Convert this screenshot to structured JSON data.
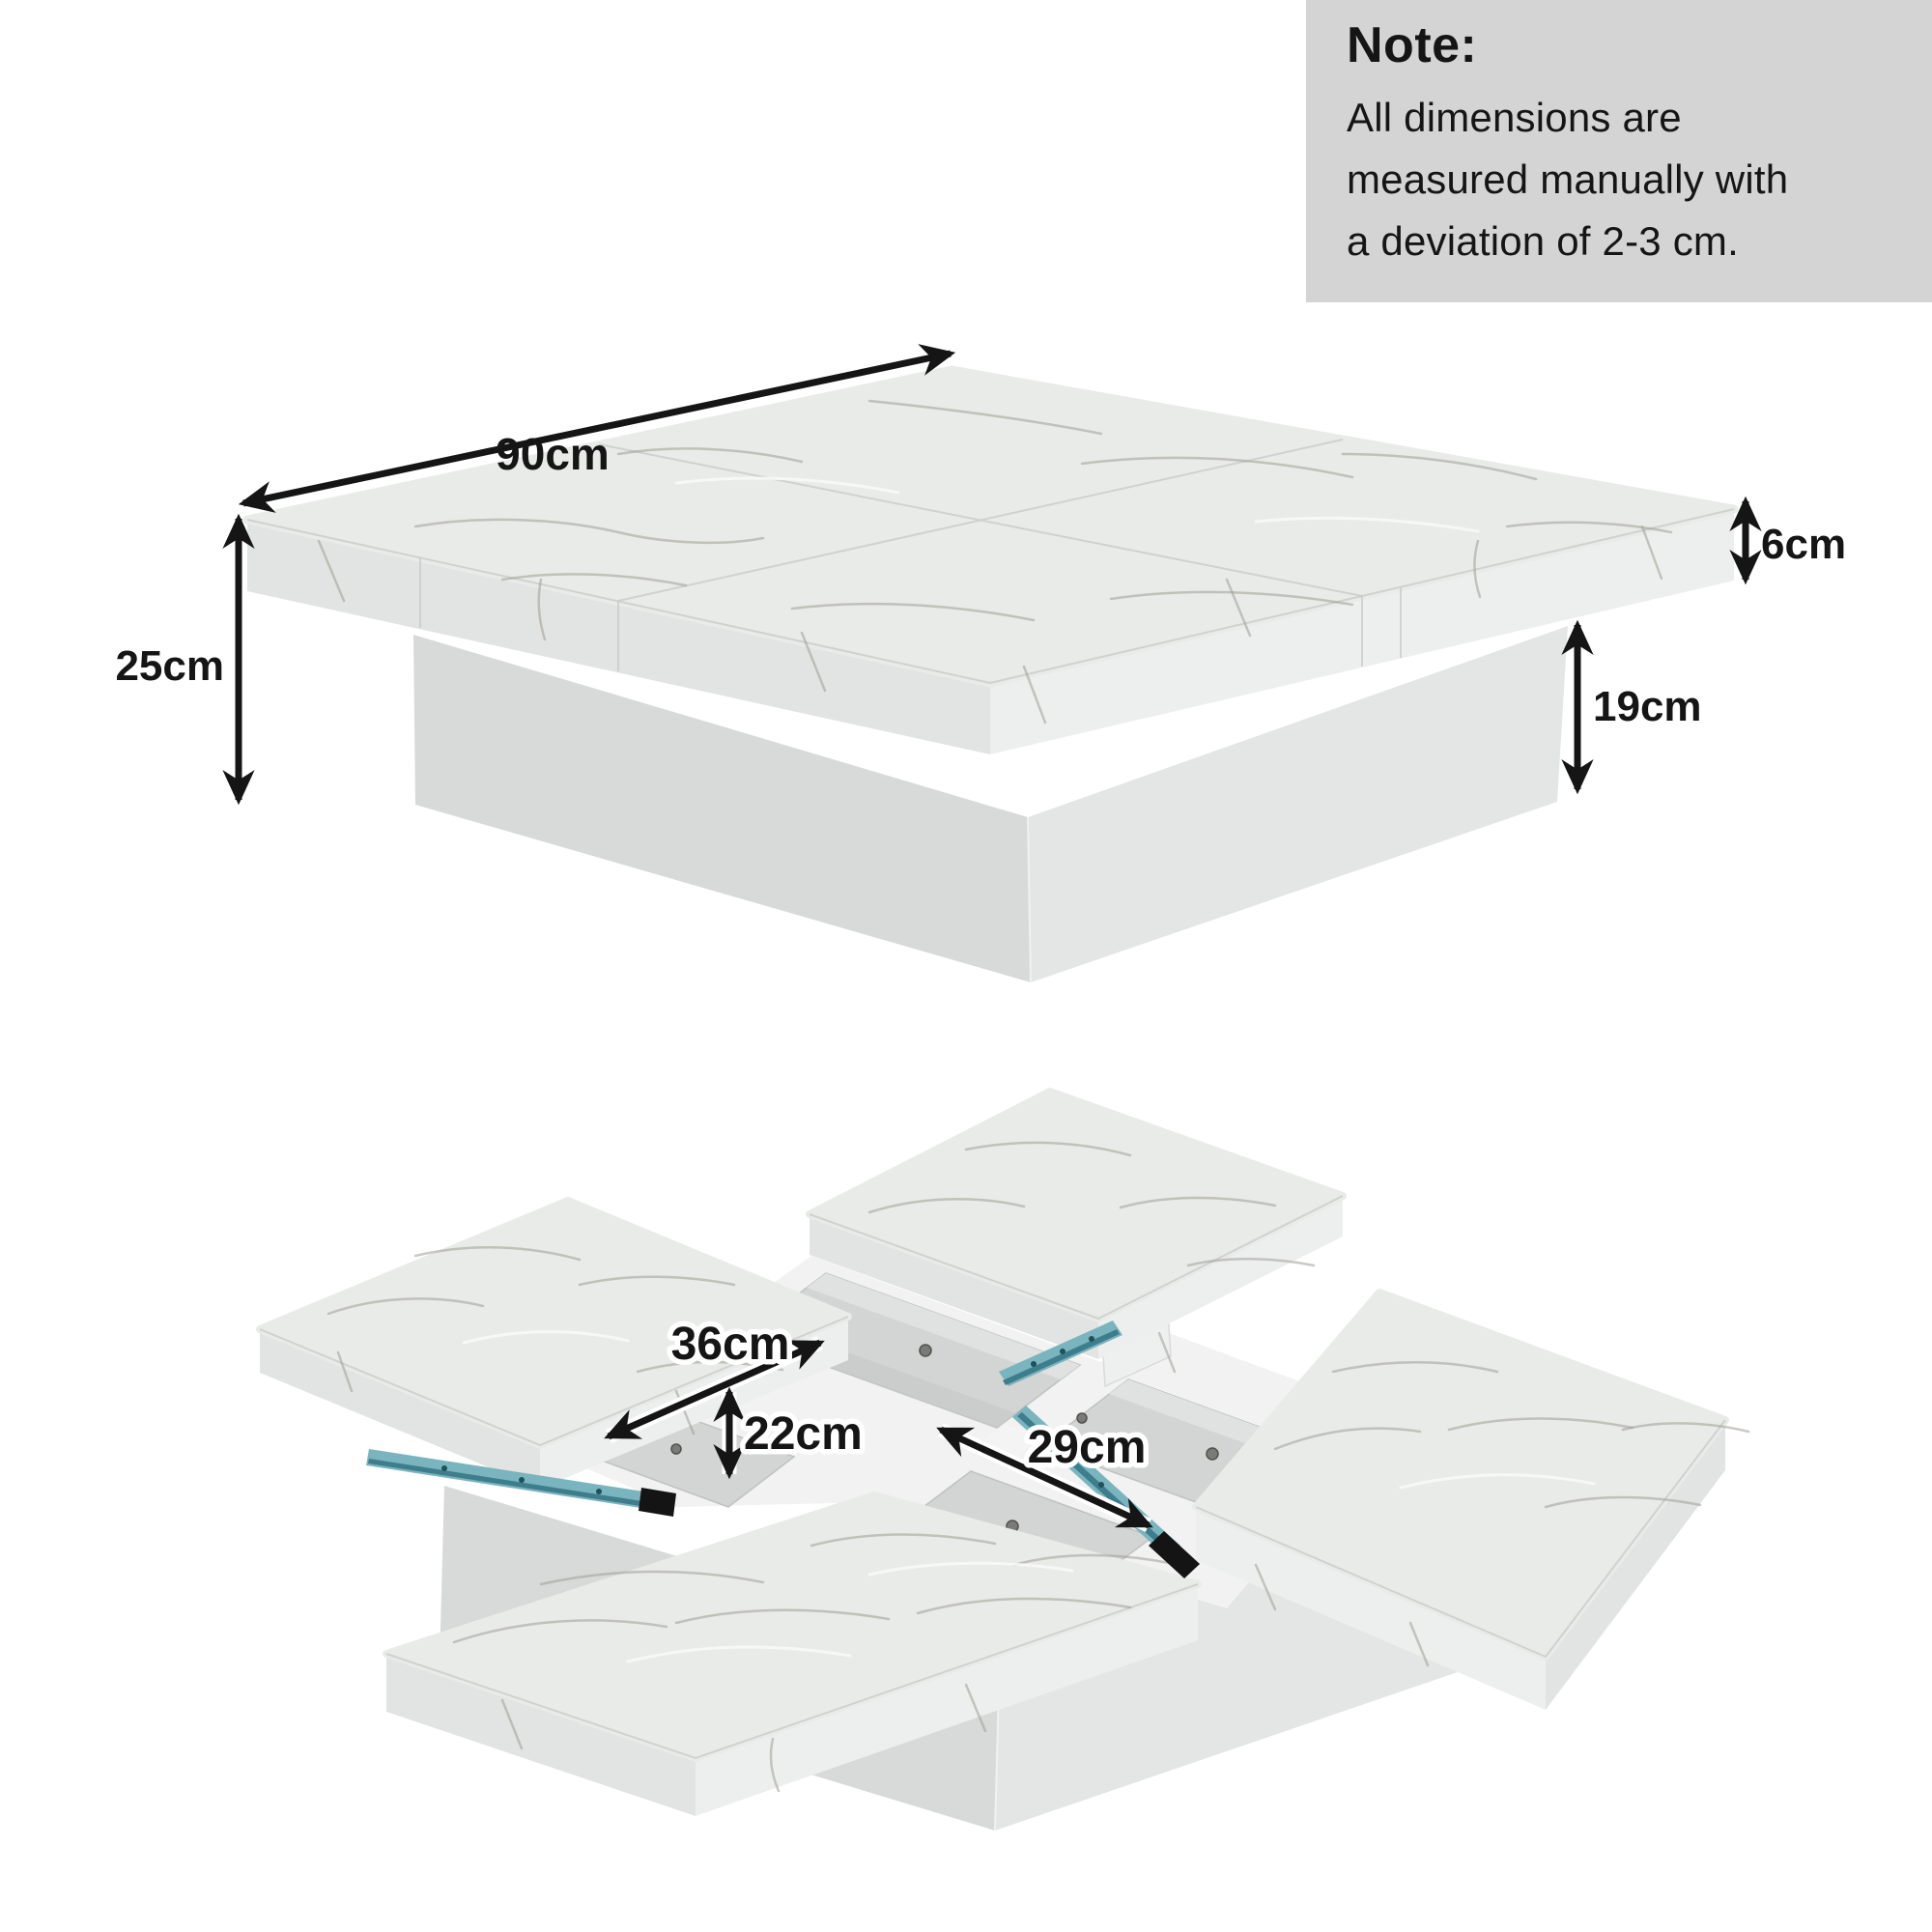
{
  "note": {
    "title": "Note:",
    "lines": [
      "All dimensions are",
      "measured manually with",
      "a deviation of 2-3 cm."
    ]
  },
  "figures": {
    "top_view": {
      "description": "closed square coffee table on plinth base",
      "dims": {
        "width": {
          "label": "90cm"
        },
        "total_height": {
          "label": "25cm"
        },
        "top_thickness": {
          "label": "6cm"
        },
        "base_height": {
          "label": "19cm"
        }
      }
    },
    "open_view": {
      "description": "table with four sliding top panels extended showing storage compartments",
      "dims": {
        "panel_extension": {
          "label": "36cm"
        },
        "compartment_height": {
          "label": "22cm"
        },
        "compartment_width": {
          "label": "29cm"
        }
      }
    }
  },
  "colors": {
    "note_bg": "#d3d4d3",
    "ink": "#151515",
    "marble_top": "#e9ebe9",
    "marble_face_light": "#edefee",
    "marble_face_dark": "#e2e4e3",
    "base_light": "#e4e6e5",
    "base_dark": "#d7dad9",
    "vein": "#a09d96",
    "well": "#d2d5d4",
    "well_light": "#e0e2e1",
    "well_dark": "#c6c9c8",
    "divider": "#f1f2f1",
    "rail": "#7ab4be",
    "rail_dark": "#3e7d8b",
    "rail_cap": "#141414"
  }
}
